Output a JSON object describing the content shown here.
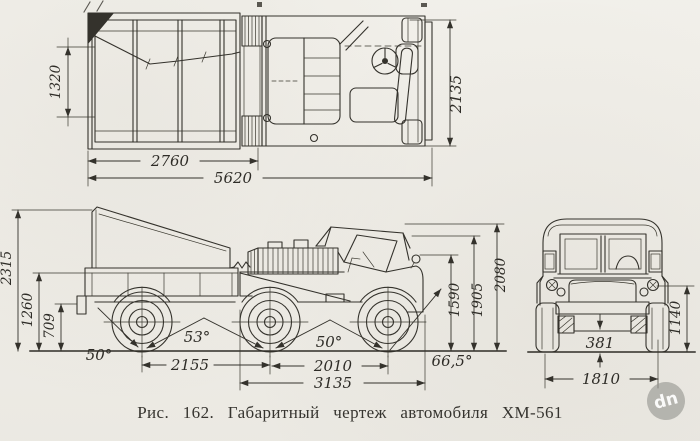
{
  "caption": "Рис. 162. Габаритный чертеж автомобиля ХМ-561",
  "top_view": {
    "inner_width": "1320",
    "trailer_length": "2760",
    "overall_length": "5620",
    "overall_width": "2135"
  },
  "side_view": {
    "overall_height": "2315",
    "bed_height": "1260",
    "hitch_height": "709",
    "departure_angle": "50°",
    "rear_breakover_angle": "53°",
    "rear_axle_spacing": "2155",
    "front_breakover_angle": "50°",
    "wheelbase": "2010",
    "front_unit_length": "3135",
    "approach_angle": "66,5°",
    "windshield_height": "1590",
    "cab_height": "1905",
    "canvas_height": "2080"
  },
  "front_view": {
    "ground_clearance": "381",
    "track_width": "1810",
    "headlight_height": "1140"
  },
  "watermark": {
    "label": "dn"
  }
}
